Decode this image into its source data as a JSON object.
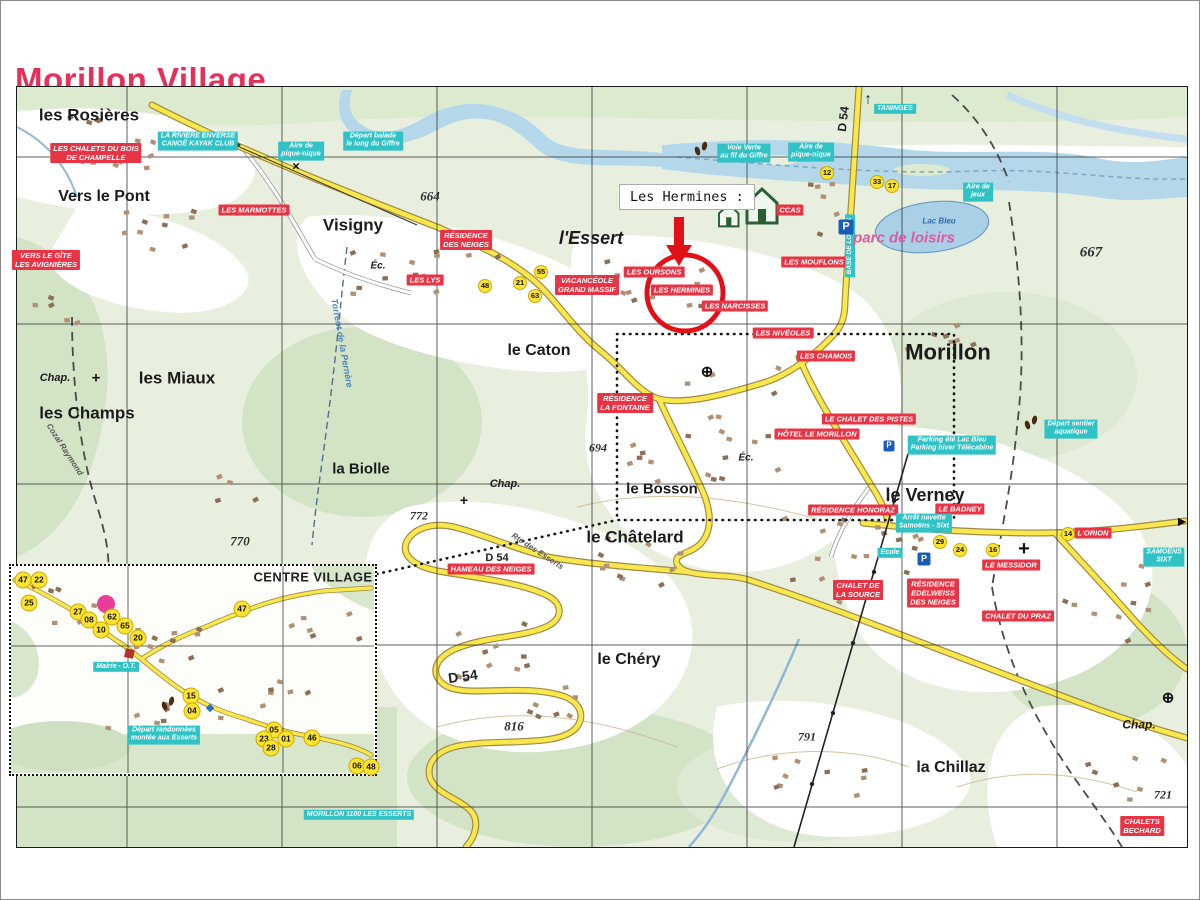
{
  "title": "Morillon Village",
  "callout": {
    "text": "Les Hermines :"
  },
  "colors": {
    "title_pink": "#e5305a",
    "lodging_red": "#e83444",
    "info_cyan": "#31c2c6",
    "road_yellow": "#f9e84b",
    "water_blue": "#b4d7ea",
    "highlight_red": "#e01218"
  },
  "map": {
    "place_names": [
      {
        "text": "les Rosières",
        "x": 88,
        "y": 114,
        "size": 17
      },
      {
        "text": "Vers le Pont",
        "x": 103,
        "y": 196,
        "size": 16
      },
      {
        "text": "Visigny",
        "x": 352,
        "y": 224,
        "size": 17
      },
      {
        "text": "l'Essert",
        "x": 590,
        "y": 237,
        "size": 18,
        "italic": true
      },
      {
        "text": "le Caton",
        "x": 538,
        "y": 350,
        "size": 16
      },
      {
        "text": "les Miaux",
        "x": 176,
        "y": 377,
        "size": 17
      },
      {
        "text": "les Champs",
        "x": 86,
        "y": 412,
        "size": 17
      },
      {
        "text": "la Biolle",
        "x": 360,
        "y": 469,
        "size": 15
      },
      {
        "text": "le Bosson",
        "x": 661,
        "y": 489,
        "size": 15
      },
      {
        "text": "le Châtelard",
        "x": 634,
        "y": 536,
        "size": 17
      },
      {
        "text": "le Verney",
        "x": 924,
        "y": 494,
        "size": 18
      },
      {
        "text": "Morillon",
        "x": 947,
        "y": 352,
        "size": 22,
        "weight": 800
      },
      {
        "text": "le Chéry",
        "x": 628,
        "y": 659,
        "size": 16
      },
      {
        "text": "la Chillaz",
        "x": 950,
        "y": 767,
        "size": 16
      },
      {
        "text": "Chap.",
        "x": 54,
        "y": 377,
        "size": 11,
        "italic": true
      },
      {
        "text": "Chap.",
        "x": 504,
        "y": 483,
        "size": 11,
        "italic": true
      },
      {
        "text": "Chap.",
        "x": 1138,
        "y": 724,
        "size": 12,
        "italic": true
      },
      {
        "text": "Éc.",
        "x": 377,
        "y": 265,
        "size": 10,
        "italic": true
      },
      {
        "text": "Éc.",
        "x": 745,
        "y": 457,
        "size": 10,
        "italic": true
      }
    ],
    "elevations": [
      {
        "text": "664",
        "x": 429,
        "y": 196,
        "size": 13
      },
      {
        "text": "667",
        "x": 1090,
        "y": 252,
        "size": 15
      },
      {
        "text": "694",
        "x": 597,
        "y": 447,
        "size": 12
      },
      {
        "text": "770",
        "x": 239,
        "y": 541,
        "size": 13
      },
      {
        "text": "772",
        "x": 418,
        "y": 515,
        "size": 12
      },
      {
        "text": "816",
        "x": 513,
        "y": 726,
        "size": 13
      },
      {
        "text": "791",
        "x": 806,
        "y": 736,
        "size": 12
      },
      {
        "text": "721",
        "x": 1162,
        "y": 794,
        "size": 12
      }
    ],
    "road_labels": [
      {
        "text": "D 54",
        "x": 843,
        "y": 118,
        "rot": -83,
        "size": 12
      },
      {
        "text": "D 54",
        "x": 496,
        "y": 557,
        "size": 11
      },
      {
        "text": "D 54",
        "x": 462,
        "y": 676,
        "rot": -8,
        "size": 14
      },
      {
        "text": "Rte des Esserts",
        "x": 536,
        "y": 551,
        "rot": 33,
        "size": 8,
        "cls": "pathlbl"
      },
      {
        "text": "Cozal Raymond",
        "x": 63,
        "y": 449,
        "rot": 57,
        "size": 8,
        "cls": "pathlbl"
      },
      {
        "text": "Torrent de la Pernère",
        "x": 341,
        "y": 342,
        "rot": 80,
        "size": 9,
        "cls": "streamlbl"
      }
    ],
    "red_labels": [
      {
        "text": "LES CHALETS DU BOIS\nDE CHAMPELLE",
        "x": 95,
        "y": 152
      },
      {
        "text": "LES MARMOTTES",
        "x": 253,
        "y": 209
      },
      {
        "text": "VERS LE GÎTE\nLES AVIGNIÈRES",
        "x": 45,
        "y": 259
      },
      {
        "text": "RÉSIDENCE\nDES NEIGES",
        "x": 465,
        "y": 239
      },
      {
        "text": "LES LYS",
        "x": 424,
        "y": 279
      },
      {
        "text": "VACANCÉOLE\nGRAND MASSIF",
        "x": 586,
        "y": 284
      },
      {
        "text": "LES OURSONS",
        "x": 653,
        "y": 271
      },
      {
        "text": "LES HERMINES",
        "x": 681,
        "y": 289
      },
      {
        "text": "LES NARCISSES",
        "x": 734,
        "y": 305
      },
      {
        "text": "LES MOUFLONS",
        "x": 813,
        "y": 261
      },
      {
        "text": "LES NIVÉOLES",
        "x": 782,
        "y": 332
      },
      {
        "text": "LES CHAMOIS",
        "x": 825,
        "y": 355
      },
      {
        "text": "LE CHALET DES PISTES",
        "x": 868,
        "y": 418
      },
      {
        "text": "HÔTEL LE MORILLON",
        "x": 816,
        "y": 433
      },
      {
        "text": "RÉSIDENCE\nLA FONTAINE",
        "x": 624,
        "y": 402
      },
      {
        "text": "RÉSIDENCE HONORAZ",
        "x": 852,
        "y": 509
      },
      {
        "text": "LE BADNEY",
        "x": 959,
        "y": 508
      },
      {
        "text": "CHALET DE\nLA SOURCE",
        "x": 857,
        "y": 589
      },
      {
        "text": "RÉSIDENCE\nEDELWEISS\nDES NEIGES",
        "x": 932,
        "y": 592
      },
      {
        "text": "LE MESSIDOR",
        "x": 1010,
        "y": 564
      },
      {
        "text": "CHALET DU PRAZ",
        "x": 1017,
        "y": 615
      },
      {
        "text": "L'ORION",
        "x": 1092,
        "y": 532
      },
      {
        "text": "CHALETS\nBECHARD",
        "x": 1141,
        "y": 825
      },
      {
        "text": "HAMEAU DES NEIGES",
        "x": 490,
        "y": 568
      },
      {
        "text": "CCAS",
        "x": 789,
        "y": 209
      }
    ],
    "cyan_labels": [
      {
        "text": "LA RIVIÈRE ENVERSE\nCANOË KAYAK CLUB",
        "x": 197,
        "y": 140
      },
      {
        "text": "Aire de\npique-nique",
        "x": 300,
        "y": 150
      },
      {
        "text": "Départ balade\nle long du Giffre",
        "x": 372,
        "y": 140
      },
      {
        "text": "Voie Verte\nau fil du Giffre",
        "x": 743,
        "y": 152
      },
      {
        "text": "Aire de\npique-nique",
        "x": 810,
        "y": 151
      },
      {
        "text": "TANINGES",
        "x": 894,
        "y": 108
      },
      {
        "text": "Aire de\njeux",
        "x": 977,
        "y": 191
      },
      {
        "text": "BASE DE LOISIRS",
        "x": 849,
        "y": 245,
        "rot": -90,
        "size": 6.5
      },
      {
        "text": "Parking été Lac Bleu\nParking hiver Télécabine",
        "x": 951,
        "y": 444
      },
      {
        "text": "Départ sentier\naquatique",
        "x": 1070,
        "y": 428
      },
      {
        "text": "Arrêt navette\nSamoëns - Sixt",
        "x": 923,
        "y": 522
      },
      {
        "text": "École",
        "x": 889,
        "y": 552
      },
      {
        "text": "SAMOËNS\nSIXT",
        "x": 1163,
        "y": 556
      },
      {
        "text": "MORILLON 1100 LES ESSERTS",
        "x": 358,
        "y": 814
      },
      {
        "text": "Départ randonnées\nmontée aux Esserts",
        "x": 163,
        "y": 734
      },
      {
        "text": "Mairie - O.T.",
        "x": 115,
        "y": 666
      }
    ],
    "area_labels": [
      {
        "text": "parc de loisirs",
        "x": 903,
        "y": 238,
        "size": 15,
        "cls": "pinklbl"
      },
      {
        "text": "Lac Bleu",
        "x": 938,
        "y": 221,
        "size": 8,
        "cls": "bluelbl"
      }
    ],
    "stops": [
      {
        "n": "12",
        "x": 826,
        "y": 172
      },
      {
        "n": "33",
        "x": 876,
        "y": 181
      },
      {
        "n": "17",
        "x": 891,
        "y": 185
      },
      {
        "n": "48",
        "x": 484,
        "y": 285
      },
      {
        "n": "21",
        "x": 519,
        "y": 282
      },
      {
        "n": "55",
        "x": 540,
        "y": 271
      },
      {
        "n": "63",
        "x": 534,
        "y": 295
      },
      {
        "n": "29",
        "x": 939,
        "y": 541
      },
      {
        "n": "24",
        "x": 959,
        "y": 549
      },
      {
        "n": "16",
        "x": 992,
        "y": 549
      },
      {
        "n": "14",
        "x": 1067,
        "y": 533
      }
    ],
    "parkings": [
      {
        "label": "P",
        "x": 845,
        "y": 226,
        "size": 15
      },
      {
        "label": "P",
        "x": 888,
        "y": 445,
        "size": 11
      },
      {
        "label": "P",
        "x": 923,
        "y": 558,
        "size": 13
      }
    ],
    "icons": [
      {
        "kind": "footprints",
        "x": 700,
        "y": 148
      },
      {
        "kind": "footprints",
        "x": 1030,
        "y": 422
      },
      {
        "kind": "footprints",
        "x": 167,
        "y": 703
      },
      {
        "kind": "church-cross",
        "x": 95,
        "y": 378,
        "size": 15
      },
      {
        "kind": "church-cross",
        "x": 463,
        "y": 500,
        "size": 14
      },
      {
        "kind": "calvary-cross",
        "x": 1023,
        "y": 548,
        "size": 20
      },
      {
        "kind": "circle-cross",
        "x": 706,
        "y": 372,
        "size": 15
      },
      {
        "kind": "circle-cross",
        "x": 1167,
        "y": 698,
        "size": 15
      },
      {
        "kind": "x-mark",
        "x": 295,
        "y": 166,
        "size": 13
      },
      {
        "kind": "arrow-up",
        "x": 867,
        "y": 99,
        "size": 15
      },
      {
        "kind": "arrow-right",
        "x": 1181,
        "y": 521,
        "size": 10
      }
    ],
    "inset": {
      "title": "CENTRE VILLAGE",
      "title_x": 312,
      "title_y": 577,
      "stops": [
        {
          "n": "47",
          "x": 22,
          "y": 579
        },
        {
          "n": "22",
          "x": 38,
          "y": 579
        },
        {
          "n": "25",
          "x": 28,
          "y": 602
        },
        {
          "n": "27",
          "x": 77,
          "y": 611
        },
        {
          "n": "08",
          "x": 88,
          "y": 619
        },
        {
          "n": "62",
          "x": 111,
          "y": 616
        },
        {
          "n": "10",
          "x": 100,
          "y": 629
        },
        {
          "n": "65",
          "x": 124,
          "y": 625
        },
        {
          "n": "20",
          "x": 137,
          "y": 637
        },
        {
          "n": "47",
          "x": 241,
          "y": 608
        },
        {
          "n": "15",
          "x": 190,
          "y": 695
        },
        {
          "n": "04",
          "x": 191,
          "y": 710
        },
        {
          "n": "05",
          "x": 273,
          "y": 729
        },
        {
          "n": "23",
          "x": 263,
          "y": 738
        },
        {
          "n": "28",
          "x": 270,
          "y": 747
        },
        {
          "n": "01",
          "x": 285,
          "y": 738
        },
        {
          "n": "46",
          "x": 311,
          "y": 737
        },
        {
          "n": "06",
          "x": 356,
          "y": 765
        },
        {
          "n": "48",
          "x": 370,
          "y": 766
        }
      ]
    }
  }
}
